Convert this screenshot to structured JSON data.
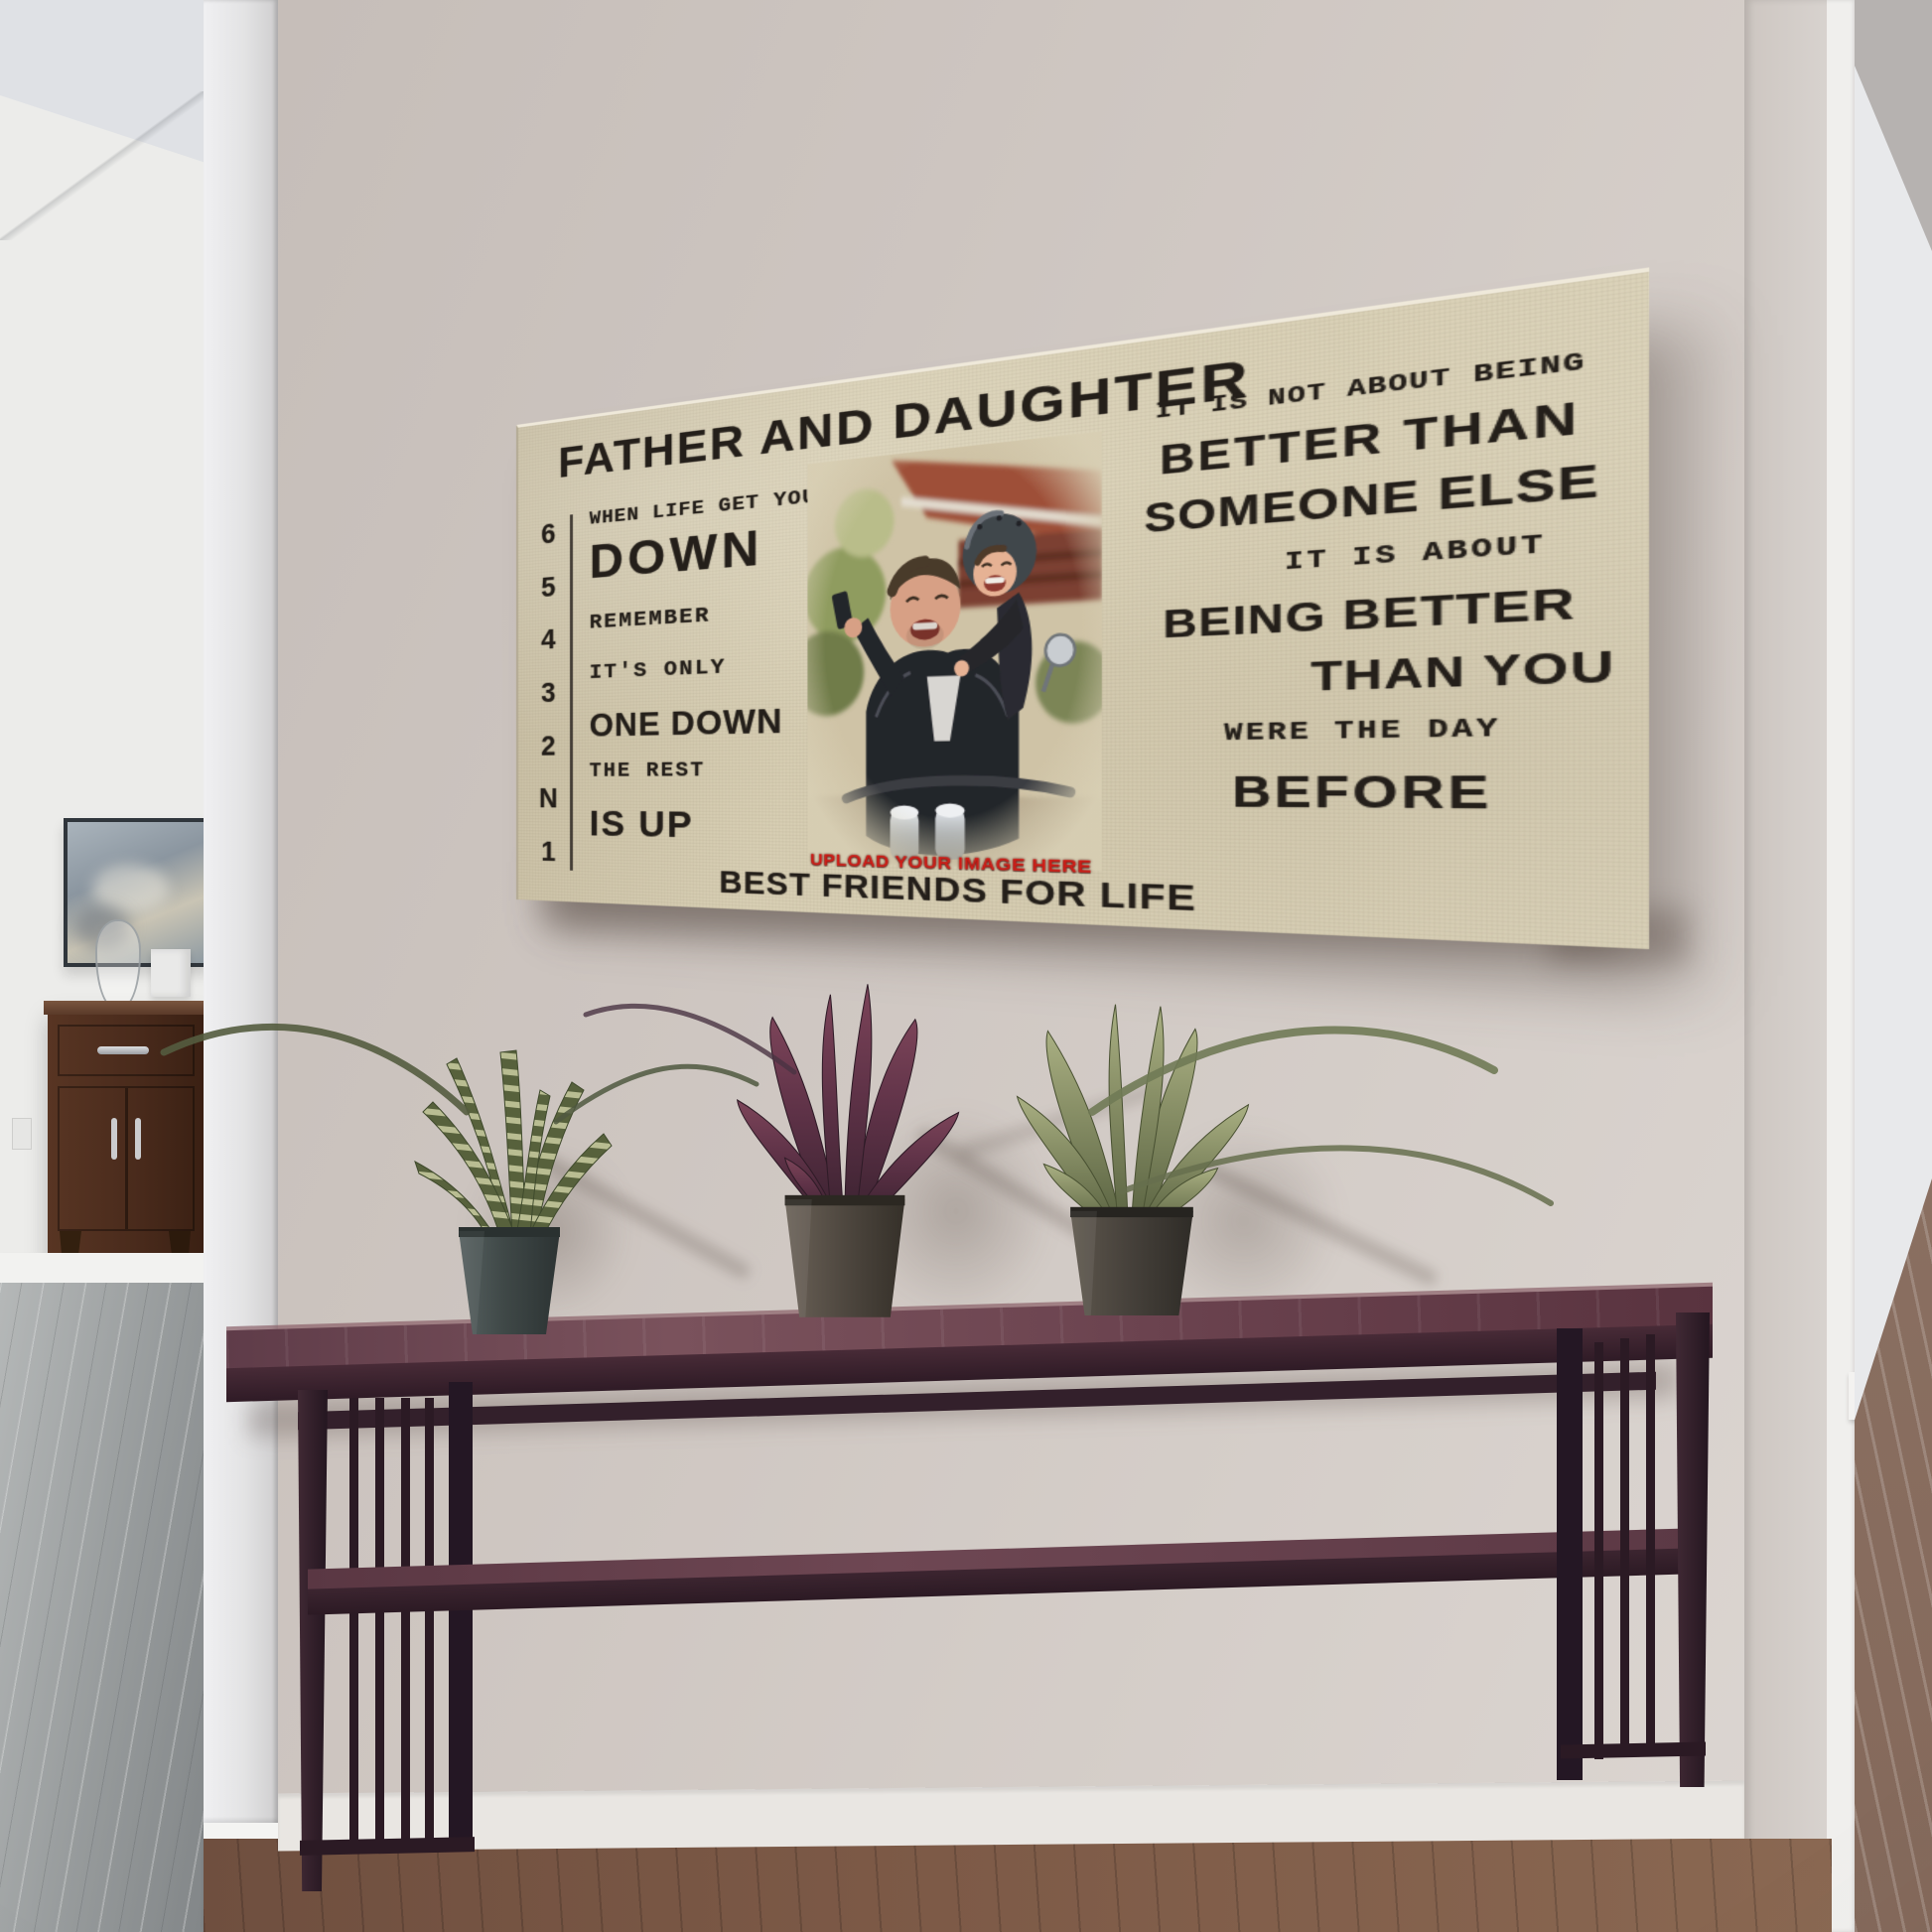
{
  "canvas": {
    "title": "FATHER AND DAUGHTER",
    "gear_numbers": [
      "6",
      "5",
      "4",
      "3",
      "2",
      "N",
      "1"
    ],
    "left_block": {
      "line1": "WHEN LIFE GET YOU",
      "line2": "DOWN",
      "line3": "REMEMBER",
      "line4": "IT'S ONLY",
      "line5": "ONE DOWN",
      "line6": "THE REST",
      "line7": "IS UP"
    },
    "right_block": {
      "line1": "IT IS NOT ABOUT BEING",
      "line2": "BETTER THAN",
      "line3": "SOMEONE ELSE",
      "line4": "IT IS ABOUT",
      "line5": "BEING BETTER",
      "line6": "THAN YOU",
      "line7": "WERE THE DAY",
      "line8": "BEFORE"
    },
    "photo_caption": "UPLOAD YOUR IMAGE HERE",
    "footer": "BEST FRIENDS FOR LIFE",
    "colors": {
      "canvas_background": "#d8cfb4",
      "ink": "#241f1a",
      "accent_red": "#cf1d17"
    }
  },
  "room": {
    "colors": {
      "main_wall": "#cfc8c3",
      "right_wall": "#d6d1cd",
      "pillar": "#ececee",
      "table_wood": "#4a2b38",
      "left_room_wall": "#ececea",
      "left_room_floor": "#9b9fa0",
      "main_floor": "#7a5a47",
      "doorway_interior": "#e8e9eb"
    }
  }
}
